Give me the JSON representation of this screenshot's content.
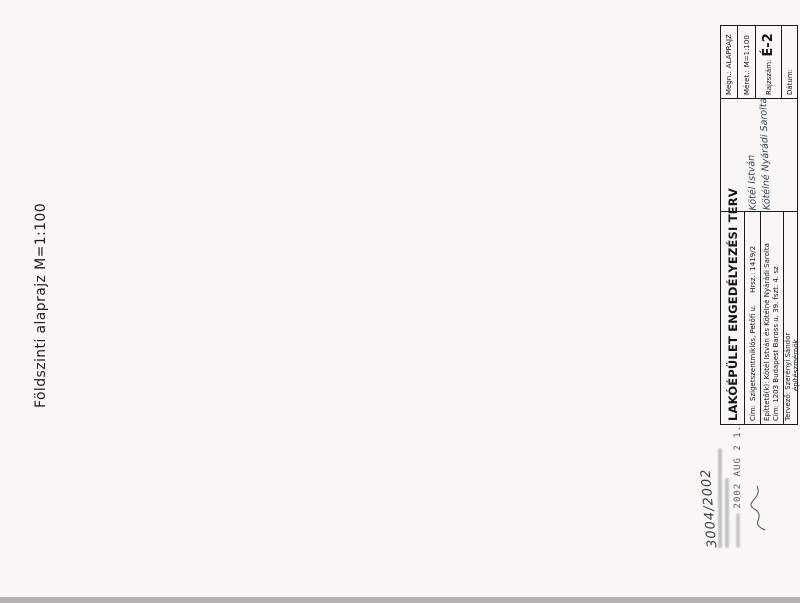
{
  "sheet": {
    "plan_title": "Földszinti alaprajz  M=1:100",
    "titleblock": {
      "project_title": "LAKÓÉPÜLET ENGEDÉLYEZÉSI TERV",
      "site_label": "Cím:",
      "site": "Szigetszentmiklós, Petőfi u.",
      "parcel": "Hrsz.: 1419/2",
      "client_label": "Építtető(k):",
      "client": "Kötél István és Kötélné Nyárádi Sarolta",
      "client_handwriting_1": "Kötél István",
      "client_handwriting_2": "Kötélné Nyárádi Sarolta",
      "client_address_label": "Cím:",
      "client_address": "1203 Budapest Baross u. 39. fszt. 4. sz",
      "designer_label": "Tervező:",
      "designer": "Szerényi Sándor",
      "designer_title": "építészmérnök",
      "drawing_name_label": "Megn.:",
      "drawing_name": "ALAPRAJZ",
      "scale_label": "Méret.:",
      "scale": "M=1:100",
      "drawing_no_label": "Rajzszám:",
      "drawing_no": "É-2",
      "date_label": "Dátum:"
    },
    "stamp": {
      "file_number": "3004/2002",
      "date_stamp": "2002 AUG 2 1."
    }
  },
  "plan": {
    "jarda": "járda",
    "covered_note": "a fedett rész határa",
    "rooms": [
      {
        "lines": [
          "Konyha",
          "kerámia",
          "10,96 m²"
        ],
        "x": 207,
        "y": 233
      },
      {
        "lines": [
          "Étkező",
          "kerámia",
          "10,63 m²"
        ],
        "x": 296,
        "y": 232
      },
      {
        "lines": [
          "Kamra",
          "ker.",
          "4,55 m²"
        ],
        "x": 355,
        "y": 228
      },
      {
        "lines": [
          "Zuhany",
          "kerámia",
          "6,00 m²"
        ],
        "x": 408,
        "y": 228
      },
      {
        "lines": [
          "Szauna",
          "4,97 m²"
        ],
        "x": 477,
        "y": 228
      },
      {
        "lines": [
          "Tároló",
          "kerámia",
          "12,78 m²"
        ],
        "x": 552,
        "y": 248
      },
      {
        "lines": [
          "Nappali",
          "kerámia",
          "31,39 m²"
        ],
        "x": 283,
        "y": 330
      },
      {
        "lines": [
          "Terasz",
          "fagy. ker.",
          "46,08 m²"
        ],
        "x": 152,
        "y": 312
      },
      {
        "lines": [
          "Előtér",
          "kerámia",
          "5,90 m²"
        ],
        "x": 364,
        "y": 300
      },
      {
        "lines": [
          "Közl.",
          "ker.",
          "5,52"
        ],
        "x": 406,
        "y": 262
      },
      {
        "lines": [
          "w.c.",
          "ker.",
          "1,51 m²"
        ],
        "x": 402,
        "y": 321
      },
      {
        "lines": [
          "Háztartási",
          "kerámia",
          "7,21 m²"
        ],
        "x": 466,
        "y": 312
      },
      {
        "lines": [
          "Garázs",
          "műgyanta",
          "22,05 m²"
        ],
        "x": 505,
        "y": 358
      },
      {
        "lines": [
          "szerelőakna"
        ],
        "x": 576,
        "y": 357
      }
    ],
    "levels": [
      {
        "t": "+0,15",
        "x": 265,
        "y": 289
      },
      {
        "t": "+0,15",
        "x": 152,
        "y": 351
      },
      {
        "t": "+0,45",
        "x": 454,
        "y": 283
      },
      {
        "t": "+0,45",
        "x": 526,
        "y": 223
      },
      {
        "t": "+0,02",
        "x": 516,
        "y": 355
      }
    ],
    "dims_h": [
      {
        "y": 137,
        "x1": 176,
        "x2": 612,
        "labels": [
          {
            "t": "20,19",
            "x": 394
          }
        ]
      },
      {
        "y": 148,
        "x1": 176,
        "x2": 612,
        "labels": [
          {
            "t": "10",
            "x": 183
          },
          {
            "t": "8,63",
            "x": 296
          },
          {
            "t": "18",
            "x": 420
          },
          {
            "t": "6,67",
            "x": 505
          },
          {
            "t": "38",
            "x": 603
          }
        ]
      },
      {
        "y": 159,
        "x1": 176,
        "x2": 612,
        "labels": [
          {
            "t": "38",
            "x": 190
          },
          {
            "t": "4,38",
            "x": 266
          },
          {
            "t": "6",
            "x": 427
          },
          {
            "t": "2,18",
            "x": 450
          },
          {
            "t": "6",
            "x": 471
          },
          {
            "t": "2,32",
            "x": 492
          },
          {
            "t": "25",
            "x": 521
          },
          {
            "t": "3,50",
            "x": 549
          },
          {
            "t": "38",
            "x": 600
          }
        ]
      },
      {
        "y": 171,
        "x1": 176,
        "x2": 612,
        "labels": [
          {
            "t": "5,75",
            "x": 212
          },
          {
            "t": "4,15",
            "x": 300
          },
          {
            "t": "2,00",
            "x": 341
          },
          {
            "t": "1,43",
            "x": 370
          },
          {
            "t": "90",
            "x": 390
          },
          {
            "t": "10",
            "x": 404
          },
          {
            "t": "25",
            "x": 470
          },
          {
            "t": "3,50",
            "x": 510
          },
          {
            "t": "7,63",
            "x": 573
          }
        ]
      },
      {
        "y": 429,
        "x1": 96,
        "x2": 612,
        "labels": [
          {
            "t": "3,51",
            "x": 192
          },
          {
            "t": "2,75",
            "x": 270
          },
          {
            "t": "3,13",
            "x": 335
          },
          {
            "t": "1,80",
            "x": 384
          },
          {
            "t": "1,90",
            "x": 440
          },
          {
            "t": "1,35",
            "x": 475
          },
          {
            "t": "3,13",
            "x": 513
          },
          {
            "t": "2,13",
            "x": 567
          }
        ]
      },
      {
        "y": 441,
        "x1": 96,
        "x2": 612,
        "labels": [
          {
            "t": "38",
            "x": 100
          },
          {
            "t": "1,00",
            "x": 117
          },
          {
            "t": "38",
            "x": 134
          },
          {
            "t": "7,25",
            "x": 280
          },
          {
            "t": "38",
            "x": 372
          },
          {
            "t": "1,87",
            "x": 394
          },
          {
            "t": "10",
            "x": 407
          },
          {
            "t": "90",
            "x": 420
          },
          {
            "t": "38",
            "x": 450
          },
          {
            "t": "3,70",
            "x": 478
          },
          {
            "t": "25",
            "x": 506
          },
          {
            "t": "3,50",
            "x": 536
          },
          {
            "t": "38",
            "x": 597
          }
        ]
      },
      {
        "y": 452,
        "x1": 96,
        "x2": 612,
        "labels": [
          {
            "t": "38",
            "x": 115
          },
          {
            "t": "8,63",
            "x": 290
          },
          {
            "t": "38",
            "x": 378
          },
          {
            "t": "25",
            "x": 492
          },
          {
            "t": "3,50",
            "x": 530
          },
          {
            "t": "38",
            "x": 597
          }
        ]
      },
      {
        "y": 463,
        "x1": 96,
        "x2": 612,
        "labels": [
          {
            "t": "8,63",
            "x": 292
          },
          {
            "t": "5,54",
            "x": 427
          },
          {
            "t": "38",
            "x": 490
          },
          {
            "t": "4,50",
            "x": 522
          },
          {
            "t": "6,67",
            "x": 580
          }
        ]
      },
      {
        "y": 474,
        "x1": 96,
        "x2": 612,
        "labels": [
          {
            "t": "3,51",
            "x": 210
          },
          {
            "t": "5,88",
            "x": 305
          },
          {
            "t": "5,54",
            "x": 427
          },
          {
            "t": "5,28",
            "x": 532
          }
        ]
      },
      {
        "y": 485,
        "x1": 176,
        "x2": 612,
        "labels": [
          {
            "t": "20,19",
            "x": 384
          }
        ]
      }
    ],
    "dims_v": [
      {
        "x": 73,
        "y1": 195,
        "y2": 385,
        "labels": [
          {
            "t": "9,91",
            "y": 288
          }
        ]
      },
      {
        "x": 85,
        "y1": 195,
        "y2": 385,
        "labels": [
          {
            "t": "8,01",
            "y": 256
          },
          {
            "t": "1,90",
            "y": 372
          }
        ]
      },
      {
        "x": 97,
        "y1": 195,
        "y2": 385,
        "labels": [
          {
            "t": "5,88",
            "y": 243
          },
          {
            "t": "2,13",
            "y": 327
          },
          {
            "t": "1,90",
            "y": 374
          }
        ]
      },
      {
        "x": 109,
        "y1": 195,
        "y2": 385,
        "labels": [
          {
            "t": "2,90",
            "y": 222
          },
          {
            "t": "25",
            "y": 247
          },
          {
            "t": "4,90",
            "y": 298
          },
          {
            "t": "38",
            "y": 349
          },
          {
            "t": "1,90",
            "y": 374
          }
        ]
      },
      {
        "x": 121,
        "y1": 195,
        "y2": 385,
        "labels": [
          {
            "t": "1,73",
            "y": 210
          },
          {
            "t": "3,03",
            "y": 262
          },
          {
            "t": "3,25",
            "y": 330
          },
          {
            "t": "1,90",
            "y": 374
          }
        ]
      },
      {
        "x": 622,
        "y1": 192,
        "y2": 400,
        "labels": [
          {
            "t": "2,21",
            "y": 220
          },
          {
            "t": "3,43",
            "y": 283
          },
          {
            "t": "2,40",
            "y": 350
          },
          {
            "t": "1,88",
            "y": 388
          }
        ]
      },
      {
        "x": 634,
        "y1": 192,
        "y2": 400,
        "labels": [
          {
            "t": "38",
            "y": 198
          },
          {
            "t": "3,65",
            "y": 240
          },
          {
            "t": "10",
            "y": 285
          },
          {
            "t": "2,00",
            "y": 316
          },
          {
            "t": "5,40",
            "y": 362
          }
        ]
      },
      {
        "x": 646,
        "y1": 192,
        "y2": 400,
        "labels": [
          {
            "t": "6",
            "y": 206
          },
          {
            "t": "2,28",
            "y": 240
          },
          {
            "t": "1,25",
            "y": 274
          },
          {
            "t": "10",
            "y": 293
          },
          {
            "t": "5,40",
            "y": 352
          }
        ]
      },
      {
        "x": 658,
        "y1": 192,
        "y2": 400,
        "labels": [
          {
            "t": "38",
            "y": 198
          },
          {
            "t": "3,65",
            "y": 244
          },
          {
            "t": "5,75",
            "y": 308
          },
          {
            "t": "38",
            "y": 344
          },
          {
            "t": "3,02",
            "y": 374
          }
        ]
      },
      {
        "x": 670,
        "y1": 192,
        "y2": 400,
        "labels": [
          {
            "t": "38",
            "y": 198
          },
          {
            "t": "9,15",
            "y": 298
          },
          {
            "t": "3,02",
            "y": 374
          }
        ]
      },
      {
        "x": 682,
        "y1": 192,
        "y2": 400,
        "labels": [
          {
            "t": "9,91",
            "y": 292
          }
        ]
      }
    ],
    "tags": [
      {
        "t": "100",
        "x": 219,
        "y": 184,
        "r": 180
      },
      {
        "t": "240",
        "x": 219,
        "y": 191,
        "r": 180
      },
      {
        "t": "100",
        "x": 311,
        "y": 184,
        "r": 180
      },
      {
        "t": "240",
        "x": 311,
        "y": 191,
        "r": 180
      },
      {
        "t": "100",
        "x": 345,
        "y": 184,
        "r": 180
      },
      {
        "t": "240",
        "x": 345,
        "y": 191,
        "r": 180
      },
      {
        "t": "80",
        "x": 457,
        "y": 183,
        "r": 180
      },
      {
        "t": "60",
        "x": 457,
        "y": 190,
        "r": 180
      },
      {
        "t": "150",
        "x": 173,
        "y": 228,
        "r": -90
      },
      {
        "t": "120",
        "x": 180,
        "y": 228,
        "r": -90
      },
      {
        "t": "áthidaló",
        "x": 222,
        "y": 219,
        "r": -90
      },
      {
        "t": "pm 90",
        "x": 215,
        "y": 301,
        "r": -90
      },
      {
        "t": "150",
        "x": 206,
        "y": 293,
        "r": -90
      },
      {
        "t": "150",
        "x": 206,
        "y": 308,
        "r": -90
      },
      {
        "t": "150",
        "x": 229,
        "y": 361,
        "r": -45
      },
      {
        "t": "240",
        "x": 240,
        "y": 371,
        "r": -45
      },
      {
        "t": "pm 90",
        "x": 284,
        "y": 353,
        "r": 180
      },
      {
        "t": "pm 90",
        "x": 320,
        "y": 353,
        "r": 180
      },
      {
        "t": "100",
        "x": 371,
        "y": 290,
        "r": -90
      },
      {
        "t": "210",
        "x": 378,
        "y": 290,
        "r": -90
      },
      {
        "t": "90",
        "x": 349,
        "y": 234,
        "r": -90
      },
      {
        "t": "210",
        "x": 356,
        "y": 234,
        "r": -90
      },
      {
        "t": "255",
        "x": 357,
        "y": 266,
        "r": -90
      },
      {
        "t": "150",
        "x": 357,
        "y": 281,
        "r": -90
      },
      {
        "t": "75",
        "x": 424,
        "y": 291,
        "r": -90
      },
      {
        "t": "pm 90",
        "x": 398,
        "y": 331,
        "r": -90
      },
      {
        "t": "75",
        "x": 436,
        "y": 252,
        "r": -90
      },
      {
        "t": "210",
        "x": 443,
        "y": 252,
        "r": -90
      },
      {
        "t": "pm 90",
        "x": 459,
        "y": 336,
        "r": 180
      },
      {
        "t": "120",
        "x": 470,
        "y": 330,
        "r": 180
      },
      {
        "t": "150",
        "x": 470,
        "y": 337,
        "r": 180
      },
      {
        "t": "pm 90",
        "x": 600,
        "y": 212,
        "r": -90
      },
      {
        "t": "150",
        "x": 607,
        "y": 232,
        "r": -90
      },
      {
        "t": "120",
        "x": 614,
        "y": 232,
        "r": -90
      },
      {
        "t": "150",
        "x": 607,
        "y": 336,
        "r": -90
      },
      {
        "t": "90",
        "x": 614,
        "y": 336,
        "r": -90
      },
      {
        "t": "pm 131",
        "x": 592,
        "y": 354,
        "r": -90
      },
      {
        "t": "150",
        "x": 607,
        "y": 372,
        "r": -90
      },
      {
        "t": "90",
        "x": 614,
        "y": 372,
        "r": -90
      },
      {
        "t": "250",
        "x": 545,
        "y": 408,
        "r": -90
      },
      {
        "t": "215",
        "x": 553,
        "y": 408,
        "r": -90
      },
      {
        "t": "60",
        "x": 409,
        "y": 337,
        "r": 180
      },
      {
        "t": "60",
        "x": 417,
        "y": 337,
        "r": 180
      },
      {
        "t": "4,89",
        "x": 589,
        "y": 442,
        "r": -90
      }
    ]
  }
}
